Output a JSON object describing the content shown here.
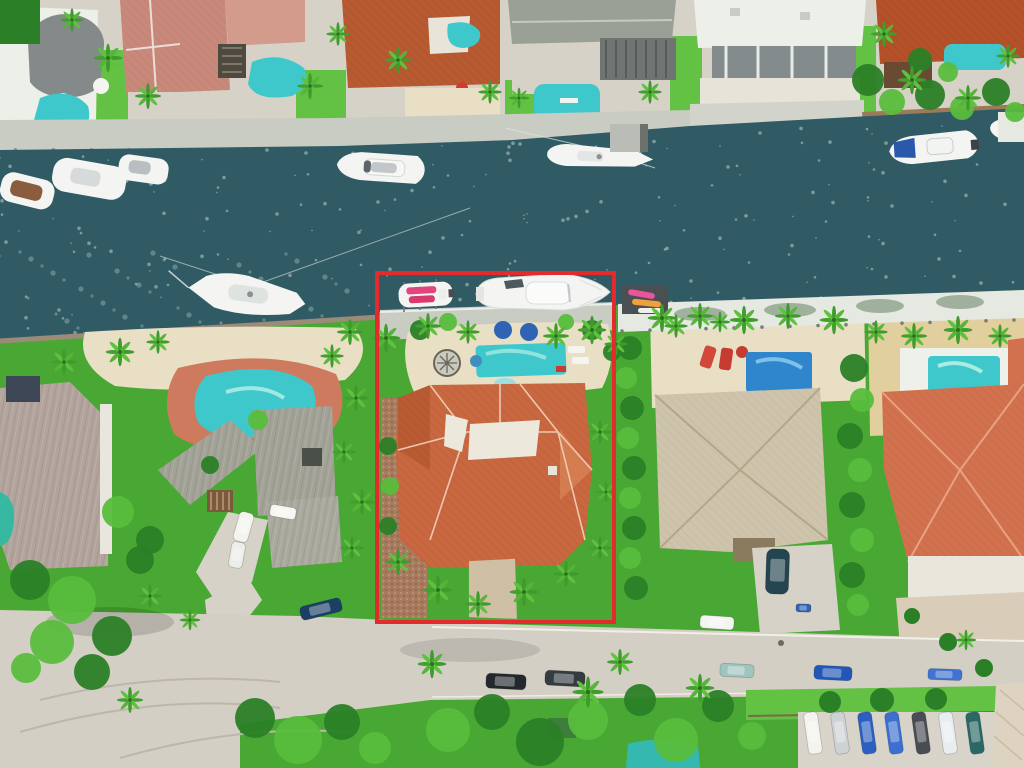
{
  "scene": {
    "type": "aerial-drone-photo",
    "description": "Aerial view of waterfront homes along a canal; a red rectangle outlines the highlighted listing property with terracotta roof, pool and two boats at its dock",
    "annotation": {
      "name": "property-boundary",
      "shape": "rectangle",
      "x1": 377,
      "y1": 273,
      "x2": 614,
      "y2": 622
    }
  },
  "colors": {
    "water": "#305b65",
    "water-light": "#3d6d77",
    "sparkle": "#d9e7e2",
    "grass": "#49a833",
    "grass-light": "#63c244",
    "grass-dark": "#2e7d25",
    "foliage-dark": "#2b7f27",
    "foliage-light": "#58bd3c",
    "sand": "#e8dfc4",
    "sand-warm": "#e2cf9e",
    "concrete": "#d6d2c7",
    "street": "#d3cfc5",
    "dock": "#c9ccc3",
    "dock-white": "#e6e8e2",
    "wood": "#9c7a58",
    "pool": "#3fc8cb",
    "pool-blue": "#2f86cc",
    "roof-subject": "#c96840",
    "roof-subject-dark": "#a94e26",
    "roof-ridge": "#ecc9ae",
    "roof-gray": "#a2a296",
    "roof-tan": "#cec4ac",
    "roof-salmon": "#d2714e",
    "roof-pink": "#c9897a",
    "roof-orange": "#b85a31",
    "roof-mauve": "#b2a49c",
    "roof-white": "#edefe9",
    "mulch": "#a87a5e",
    "deck-red": "#cd7a5e",
    "highlight": "#e32a2c",
    "boat": "#f4f5f2",
    "umbrella-blue": "#2f63b4",
    "kayak-pink": "#e8559a",
    "kayak-orange": "#f0a03c"
  },
  "objects": {
    "boats": [
      "moored-yachts-north-west",
      "motor-yacht-north",
      "sailboat-north",
      "center-console-north-east",
      "partial-boat-east-edge",
      "sailboat-south-west",
      "small-runabout-subject-dock",
      "large-motor-yacht-subject-dock"
    ],
    "pools": [
      "pool-nw-corner",
      "lagoon-pool-north",
      "courtyard-pool-north",
      "pool-north-gray-house",
      "pool-north-east",
      "kidney-pool-left-neighbor",
      "subject-pool",
      "blue-pool-right-neighbor",
      "small-pool-far-right",
      "glimpse-pool-bottom-center",
      "sliver-pool-far-left"
    ]
  },
  "vehicles": {
    "street_cars": [
      {
        "x": 700,
        "y": 616,
        "w": 34,
        "h": 13,
        "rot": 4,
        "color": "#f4f5f1"
      },
      {
        "x": 720,
        "y": 664,
        "w": 34,
        "h": 13,
        "rot": 3,
        "color": "#9fc5bf"
      },
      {
        "x": 486,
        "y": 674,
        "w": 40,
        "h": 15,
        "rot": 3,
        "color": "#23282d"
      },
      {
        "x": 545,
        "y": 671,
        "w": 40,
        "h": 15,
        "rot": 3,
        "color": "#343b41"
      },
      {
        "x": 814,
        "y": 666,
        "w": 38,
        "h": 14,
        "rot": 3,
        "color": "#2256b8"
      },
      {
        "x": 928,
        "y": 669,
        "w": 34,
        "h": 11,
        "rot": 2,
        "color": "#3f74d0"
      },
      {
        "x": 300,
        "y": 602,
        "w": 42,
        "h": 14,
        "rot": -14,
        "color": "#1c3f66"
      },
      {
        "x": 270,
        "y": 506,
        "w": 26,
        "h": 12,
        "rot": 10,
        "color": "#f6f6f2"
      },
      {
        "x": 236,
        "y": 512,
        "w": 15,
        "h": 30,
        "rot": 16,
        "color": "#f4f4ef"
      },
      {
        "x": 230,
        "y": 542,
        "w": 14,
        "h": 26,
        "rot": 10,
        "color": "#eceeea"
      },
      {
        "x": 766,
        "y": 549,
        "w": 23,
        "h": 45,
        "rot": 2,
        "color": "#24454f"
      },
      {
        "x": 796,
        "y": 604,
        "w": 15,
        "h": 8,
        "rot": 2,
        "color": "#2f63b4"
      }
    ],
    "parking_lot": {
      "x0": 806,
      "y": 712,
      "spacing": 27,
      "rot": -8,
      "w": 14,
      "h": 42,
      "colors": [
        "#f3f3ef",
        "#cdd2d4",
        "#2d5fc0",
        "#3b6fd0",
        "#474d53",
        "#e9edf0",
        "#2a6866"
      ]
    }
  },
  "greenery": {
    "palms": [
      [
        108,
        58,
        1.1
      ],
      [
        148,
        96,
        1.0
      ],
      [
        72,
        20,
        0.9
      ],
      [
        310,
        86,
        1.0
      ],
      [
        338,
        34,
        0.9
      ],
      [
        398,
        60,
        1.0
      ],
      [
        490,
        92,
        0.9
      ],
      [
        650,
        92,
        0.9
      ],
      [
        884,
        34,
        1.0
      ],
      [
        912,
        80,
        1.1
      ],
      [
        968,
        98,
        1.0
      ],
      [
        1008,
        56,
        0.9
      ],
      [
        350,
        332,
        1.0
      ],
      [
        386,
        338,
        1.1
      ],
      [
        428,
        326,
        1.0
      ],
      [
        468,
        332,
        0.9
      ],
      [
        556,
        336,
        1.0
      ],
      [
        592,
        330,
        1.1
      ],
      [
        616,
        344,
        0.9
      ],
      [
        662,
        318,
        1.1
      ],
      [
        700,
        316,
        1.0
      ],
      [
        744,
        320,
        1.1
      ],
      [
        788,
        316,
        1.0
      ],
      [
        834,
        320,
        1.1
      ],
      [
        876,
        332,
        0.9
      ],
      [
        914,
        336,
        1.0
      ],
      [
        958,
        330,
        1.1
      ],
      [
        1000,
        336,
        0.9
      ],
      [
        120,
        352,
        1.1
      ],
      [
        158,
        342,
        0.9
      ],
      [
        64,
        362,
        1.0
      ],
      [
        332,
        356,
        0.9
      ],
      [
        356,
        398,
        1.0
      ],
      [
        344,
        452,
        0.9
      ],
      [
        362,
        502,
        1.0
      ],
      [
        352,
        548,
        0.9
      ],
      [
        150,
        596,
        0.9
      ],
      [
        190,
        620,
        0.8
      ],
      [
        398,
        562,
        1.0
      ],
      [
        438,
        590,
        1.1
      ],
      [
        478,
        604,
        1.0
      ],
      [
        524,
        592,
        1.1
      ],
      [
        566,
        574,
        1.0
      ],
      [
        600,
        548,
        0.9
      ],
      [
        606,
        492,
        0.8
      ],
      [
        600,
        432,
        0.9
      ],
      [
        432,
        664,
        1.1
      ],
      [
        588,
        692,
        1.2
      ],
      [
        620,
        662,
        1.0
      ],
      [
        700,
        688,
        1.1
      ],
      [
        966,
        640,
        0.8
      ],
      [
        130,
        700,
        1.0
      ],
      [
        676,
        326,
        0.9
      ],
      [
        720,
        322,
        0.8
      ],
      [
        519,
        98,
        0.8
      ]
    ],
    "trees": [
      [
        868,
        80,
        16,
        0
      ],
      [
        892,
        102,
        13,
        1
      ],
      [
        930,
        95,
        15,
        0
      ],
      [
        962,
        108,
        12,
        1
      ],
      [
        996,
        92,
        14,
        0
      ],
      [
        1015,
        112,
        10,
        1
      ],
      [
        920,
        60,
        12,
        0
      ],
      [
        948,
        72,
        10,
        1
      ],
      [
        30,
        580,
        20,
        0
      ],
      [
        72,
        600,
        24,
        1
      ],
      [
        112,
        636,
        20,
        0
      ],
      [
        52,
        642,
        22,
        1
      ],
      [
        92,
        672,
        18,
        0
      ],
      [
        26,
        668,
        15,
        1
      ],
      [
        140,
        560,
        14,
        0
      ],
      [
        118,
        512,
        16,
        1
      ],
      [
        150,
        540,
        14,
        0
      ],
      [
        255,
        718,
        20,
        0
      ],
      [
        298,
        740,
        24,
        1
      ],
      [
        342,
        722,
        18,
        0
      ],
      [
        375,
        748,
        16,
        1
      ],
      [
        448,
        730,
        22,
        1
      ],
      [
        492,
        712,
        18,
        0
      ],
      [
        540,
        742,
        24,
        0
      ],
      [
        588,
        720,
        20,
        1
      ],
      [
        640,
        700,
        16,
        0
      ],
      [
        676,
        740,
        22,
        1
      ],
      [
        718,
        706,
        16,
        0
      ],
      [
        752,
        736,
        14,
        1
      ],
      [
        630,
        348,
        12,
        0
      ],
      [
        626,
        378,
        11,
        1
      ],
      [
        632,
        408,
        12,
        0
      ],
      [
        628,
        438,
        11,
        1
      ],
      [
        634,
        468,
        12,
        0
      ],
      [
        630,
        498,
        11,
        1
      ],
      [
        634,
        528,
        12,
        0
      ],
      [
        630,
        558,
        11,
        1
      ],
      [
        636,
        588,
        12,
        0
      ],
      [
        854,
        368,
        14,
        0
      ],
      [
        862,
        400,
        12,
        1
      ],
      [
        850,
        436,
        13,
        0
      ],
      [
        860,
        470,
        12,
        1
      ],
      [
        852,
        505,
        13,
        0
      ],
      [
        862,
        540,
        12,
        1
      ],
      [
        852,
        575,
        13,
        0
      ],
      [
        858,
        605,
        11,
        1
      ],
      [
        420,
        330,
        10,
        0
      ],
      [
        448,
        322,
        9,
        1
      ],
      [
        592,
        330,
        10,
        0
      ],
      [
        566,
        322,
        8,
        1
      ],
      [
        612,
        352,
        9,
        0
      ],
      [
        388,
        446,
        9,
        0
      ],
      [
        390,
        486,
        9,
        1
      ],
      [
        388,
        526,
        9,
        0
      ],
      [
        258,
        420,
        10,
        1
      ],
      [
        210,
        465,
        9,
        0
      ]
    ],
    "verge_bushes": [
      [
        830,
        702,
        11
      ],
      [
        882,
        700,
        12
      ],
      [
        936,
        699,
        11
      ],
      [
        912,
        616,
        8
      ],
      [
        948,
        642,
        9
      ],
      [
        984,
        668,
        9
      ]
    ]
  },
  "docks": {
    "north_piers_left": {
      "y": 148,
      "x0": 14,
      "step": 38,
      "count": 13,
      "len": 15
    },
    "north_piers_right": {
      "y": 134,
      "x0": 695,
      "step": 38,
      "count": 5,
      "len": 12
    },
    "south_pilings": {
      "x0": 622,
      "step": 28,
      "count": 15,
      "y": 331,
      "slope": -0.028
    }
  },
  "sparkles": {
    "count": 210,
    "cluster": 46
  }
}
